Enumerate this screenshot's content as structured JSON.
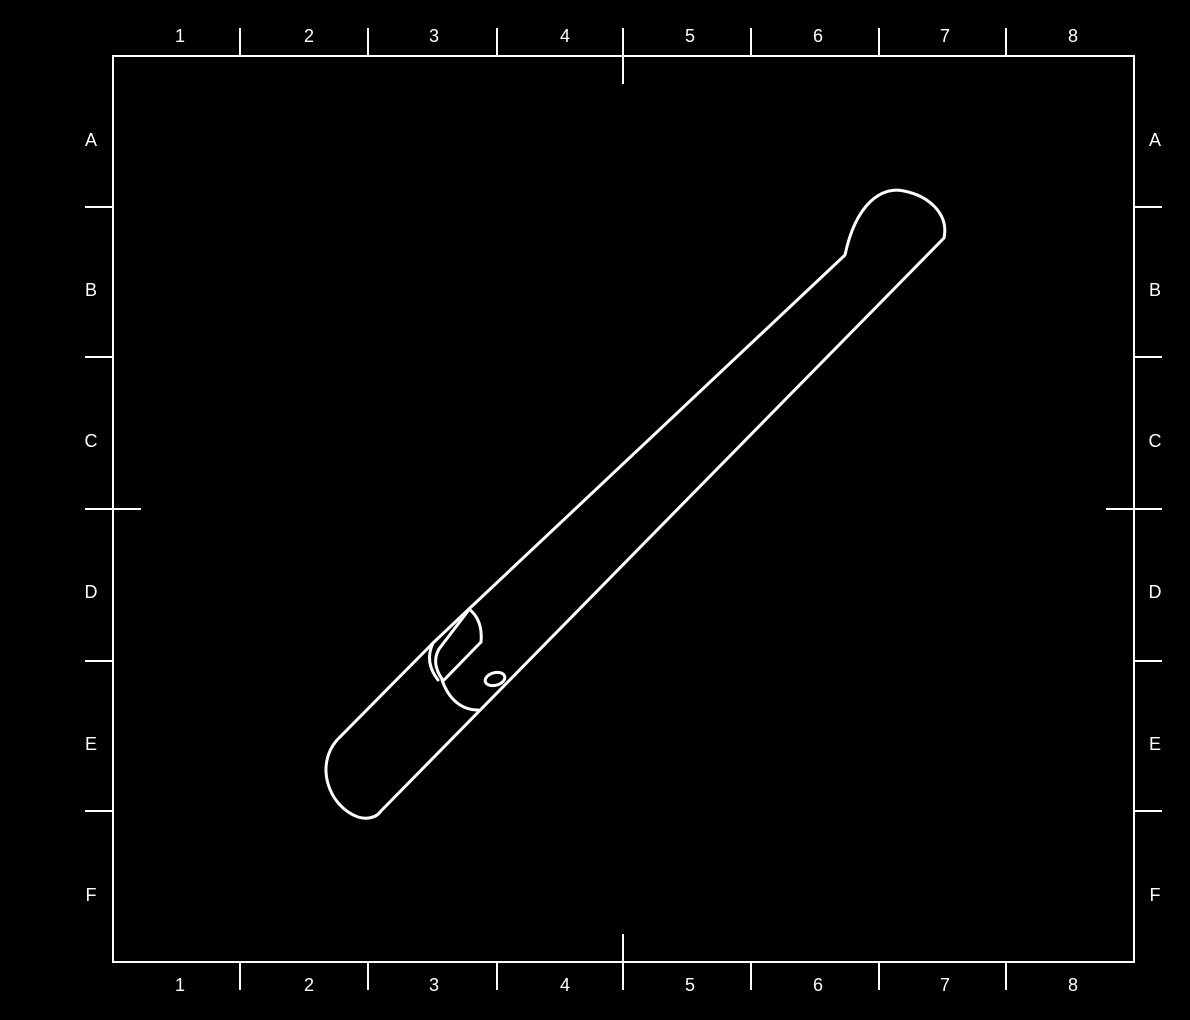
{
  "sheet": {
    "title": "technical-drawing-sheet",
    "background_color": "#000000",
    "line_color": "#ffffff",
    "frame": {
      "x": 113,
      "y": 56,
      "width": 1021,
      "height": 906,
      "stroke_width": 2
    },
    "grid_reference": {
      "column_labels": [
        "1",
        "2",
        "3",
        "4",
        "5",
        "6",
        "7",
        "8"
      ],
      "row_labels": [
        "A",
        "B",
        "C",
        "D",
        "E",
        "F"
      ],
      "column_label_x": [
        180,
        309,
        434,
        565,
        690,
        818,
        945,
        1073
      ],
      "top_label_y": 36,
      "bottom_label_y": 985,
      "row_label_y": [
        140,
        290,
        441,
        592,
        744,
        895
      ],
      "left_label_x": 91,
      "right_label_x": 1155,
      "column_tick_x": [
        240,
        368,
        497,
        623,
        751,
        879,
        1006
      ],
      "row_tick_y": [
        207,
        357,
        509,
        661,
        811
      ],
      "tick_outside_len": 28,
      "center_tick_inside_len": 28,
      "center_column_tick_index": 3,
      "center_row_tick_index": 2,
      "tick_stroke_width": 2
    },
    "part_view": {
      "name": "isometric-rod-with-notch-and-hole",
      "stroke_width": 3,
      "paths": [
        "M 470 608 L 845 255 C 856 203 882 186 904 191 C 929 196 949 214 944 238 L 381 811 C 377 817 368 820 358 817 C 328 806 315 765 337 740 L 433 643",
        "M 433 643 L 470 608",
        "M 439 649 L 468 611",
        "M 433 643 Q 424 662 438 680",
        "M 439 649 Q 431 663 442 679",
        "M 469 609 Q 483 620 481 642",
        "M 481 642 L 444 680",
        "M 442 680 C 449 700 462 710 478 710"
      ],
      "hole": {
        "cx": 495,
        "cy": 679,
        "rx": 10,
        "ry": 6.3,
        "rotate": -15
      }
    }
  }
}
